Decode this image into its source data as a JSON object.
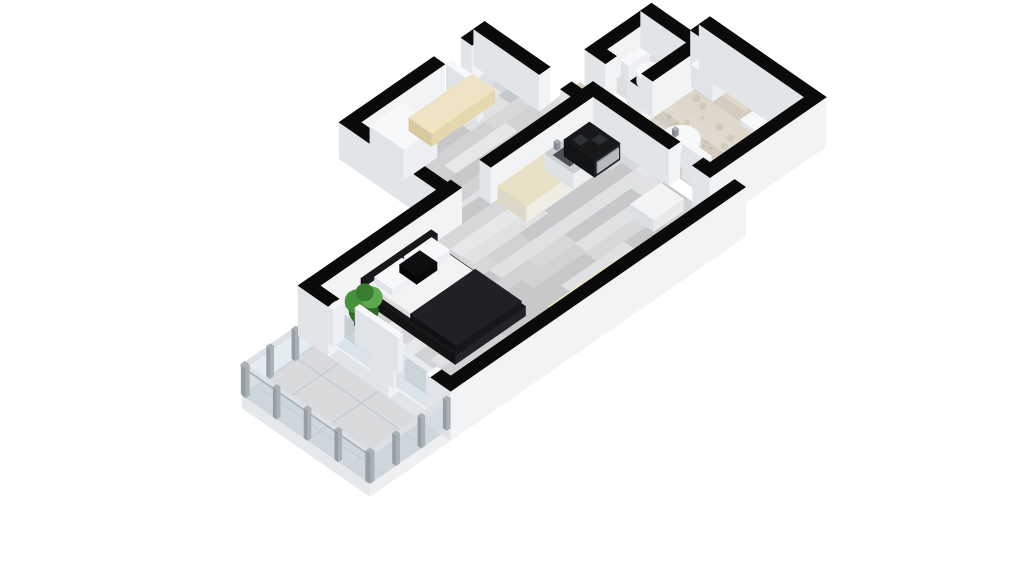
{
  "meta": {
    "kind": "3d-floorplan-render",
    "background": "#ffffff",
    "description": "Isometric 3D floor plan of a studio apartment"
  },
  "projection": {
    "ox": 320,
    "oy": 322,
    "ax": 39,
    "by": 27,
    "zs": 26,
    "wallH": 1.4
  },
  "palette": {
    "wallTop": "#0a0a0b",
    "wallS": "#f2f3f5",
    "wallW": "#e2e5e8",
    "whiteTop": "#f7f8fa",
    "whiteS": "#edeff2",
    "whiteW": "#e0e3e7",
    "creamTop": "#eee4c3",
    "creamS": "#e6d8ad",
    "creamW": "#d9c99e",
    "blackTop": "#17181a",
    "blackS": "#212326",
    "blackW": "#121315",
    "glassFill": "rgba(196,212,220,0.45)",
    "glassTop": "#e7ecef",
    "post": "#a9b0b6",
    "rail": "#dde1e5",
    "plankBase": "#d4d6d8",
    "planks": [
      "#d6d8da",
      "#cdcfd1",
      "#dfe1e3",
      "#c6c8ca",
      "#e5e7e9",
      "#d0d2d4"
    ],
    "stoneBase": "#d8d2c5",
    "stone": [
      "#d4cdbf",
      "#ded7ca",
      "#cbc4b4",
      "#e1dbcf"
    ],
    "speckle": "rgba(150,140,120,0.18)",
    "tileBase": "#d8dadc",
    "tileLine": "#c4c7ca",
    "wcFloor": "#dcdee0",
    "passFloor": "#d9dbdd",
    "potTop": "#45484a",
    "potS": "#313436",
    "potW": "#27292b",
    "leaf": [
      "#2e6b28",
      "#48913c",
      "#5ea94f",
      "#3a7d31"
    ],
    "steelTop": "#c9ced2",
    "sinkInset": "#4b5054",
    "tap": "#a8aeb3",
    "ovenBandS": "#b5bac0",
    "ovenBandTop": "#9aa0a6",
    "mattTop": "#f3f3f4",
    "mattS": "#e6e7e8",
    "mattW": "#dcdddf",
    "duvetTop": "#202124",
    "duvetS": "#17181a",
    "duvetW": "#101112"
  },
  "scene": [
    {
      "n": "balcony-slab",
      "t": "box",
      "r": [
        -2.35,
        0.35,
        -0.28,
        3.63
      ],
      "z": [
        -0.5,
        0
      ],
      "c": {
        "top": "#d8dadc",
        "s": "#eef0f2",
        "w": "#e6e9eb"
      }
    },
    {
      "n": "balcony-floor",
      "t": "floor",
      "poly": [
        [
          -2.35,
          0.35
        ],
        [
          -0.28,
          0.35
        ],
        [
          -0.28,
          3.63
        ],
        [
          -2.35,
          3.63
        ]
      ],
      "pat": "tiles",
      "seed": 5
    },
    {
      "n": "balcony-railing-north",
      "t": "railing",
      "r": [
        -2.35,
        0.32,
        -0.28,
        0.4
      ],
      "posts": 4
    },
    {
      "n": "hall-floor",
      "t": "floor",
      "poly": [
        [
          3.55,
          -2.5
        ],
        [
          6.72,
          -2.5
        ],
        [
          6.72,
          -0.28
        ],
        [
          3.55,
          -0.28
        ]
      ],
      "pat": "planks",
      "seed": 7
    },
    {
      "n": "wc-floor",
      "t": "floor",
      "poly": [
        [
          8.05,
          -0.7
        ],
        [
          9.2,
          -0.7
        ],
        [
          9.2,
          0.2
        ],
        [
          8.05,
          0.2
        ]
      ],
      "fill": "#dcdee0"
    },
    {
      "n": "doorway-floor",
      "t": "floor",
      "poly": [
        [
          6.72,
          -1.1
        ],
        [
          7.28,
          -1.1
        ],
        [
          7.28,
          -0.55
        ],
        [
          6.72,
          -0.55
        ]
      ],
      "fill": "#d9dbdd"
    },
    {
      "n": "bathroom-floor",
      "t": "floor",
      "poly": [
        [
          7.28,
          -1.1
        ],
        [
          7.77,
          -1.1
        ],
        [
          7.77,
          0.48
        ],
        [
          9.48,
          0.48
        ],
        [
          9.48,
          0.3
        ],
        [
          9.7,
          0.3
        ],
        [
          9.7,
          2.72
        ],
        [
          7.28,
          2.72
        ]
      ],
      "pat": "stone",
      "seed": 3
    },
    {
      "n": "main-room-floor",
      "t": "floor",
      "poly": [
        [
          0,
          0
        ],
        [
          3.63,
          0
        ],
        [
          3.63,
          -0.28
        ],
        [
          4.38,
          -0.28
        ],
        [
          4.38,
          0
        ],
        [
          7,
          0
        ],
        [
          7,
          3.35
        ],
        [
          0,
          3.35
        ]
      ],
      "pat": "planks",
      "seed": 11
    },
    {
      "n": "hall-north-wall-west",
      "t": "wall",
      "r": [
        3.27,
        -2.78,
        5.7,
        -2.5
      ]
    },
    {
      "n": "hall-north-wall-east",
      "t": "wall",
      "r": [
        6.4,
        -2.78,
        7.0,
        -2.5
      ]
    },
    {
      "n": "entry-door-leaf",
      "t": "box",
      "r": [
        5.72,
        -2.48,
        5.86,
        -1.68
      ],
      "z": [
        0,
        1.4
      ],
      "c": "white"
    },
    {
      "n": "hall-west-wall",
      "t": "wall",
      "r": [
        3.27,
        -2.5,
        3.55,
        -0.28
      ]
    },
    {
      "n": "hall-east-wall-north",
      "t": "wall",
      "r": [
        6.72,
        -2.78,
        7.0,
        -1.1
      ]
    },
    {
      "n": "hall-east-wall-south",
      "t": "wall",
      "r": [
        6.72,
        -0.55,
        7.0,
        -0.28
      ]
    },
    {
      "n": "hall-wardrobe",
      "t": "box",
      "r": [
        3.7,
        -2.42,
        4.55,
        -1.55
      ],
      "z": [
        0,
        1.18
      ],
      "c": "white"
    },
    {
      "n": "hall-bench",
      "t": "box",
      "r": [
        4.68,
        -2.4,
        6.3,
        -1.82
      ],
      "z": [
        0,
        0.5
      ],
      "c": "cream"
    },
    {
      "n": "wc-north-wall",
      "t": "wall",
      "r": [
        7.77,
        -0.98,
        9.48,
        -0.7
      ]
    },
    {
      "n": "wc-west-wall-upper",
      "t": "wall",
      "r": [
        7.77,
        -0.7,
        8.05,
        -0.45
      ]
    },
    {
      "n": "wc-west-wall-lower",
      "t": "wall",
      "r": [
        7.77,
        0.1,
        8.05,
        0.48
      ]
    },
    {
      "n": "toilet-tank",
      "t": "box",
      "r": [
        8.42,
        -0.7,
        8.94,
        -0.5
      ],
      "z": [
        0,
        0.6
      ],
      "c": "white"
    },
    {
      "n": "toilet-bowl",
      "t": "disk",
      "cx": 8.68,
      "cy": -0.22,
      "rad": 0.24,
      "z": [
        0,
        0.4
      ],
      "c": "white"
    },
    {
      "n": "wc-east-wall",
      "t": "wall",
      "r": [
        9.2,
        -0.98,
        9.48,
        0.48
      ]
    },
    {
      "n": "wc-south-wall",
      "t": "wall",
      "r": [
        8.05,
        0.2,
        9.2,
        0.48
      ]
    },
    {
      "n": "bathroom-ne-wall",
      "t": "wall",
      "r": [
        9.48,
        0.02,
        9.98,
        0.3
      ]
    },
    {
      "n": "washing-machine",
      "t": "box",
      "r": [
        9.12,
        0.4,
        9.64,
        0.95
      ],
      "z": [
        0,
        0.85
      ],
      "c": "white"
    },
    {
      "n": "shower-tray",
      "t": "box",
      "r": [
        9.04,
        1.74,
        9.64,
        2.62
      ],
      "z": [
        0,
        0.2
      ],
      "c": "white"
    },
    {
      "n": "round-washbasin",
      "t": "disk",
      "cx": 7.75,
      "cy": 1.5,
      "rad": 0.36,
      "z": [
        0,
        0.56
      ],
      "c": "white"
    },
    {
      "n": "basin-tap",
      "t": "box",
      "r": [
        7.71,
        1.32,
        7.79,
        1.4
      ],
      "z": [
        0.56,
        0.8
      ],
      "c": {
        "top": "#a8aeb3",
        "s": "#8f959b",
        "w": "#7f858b"
      }
    },
    {
      "n": "bathroom-door-leaf",
      "t": "box",
      "r": [
        7.3,
        1.98,
        7.44,
        2.6
      ],
      "z": [
        0,
        1.35
      ],
      "c": "white"
    },
    {
      "n": "bathroom-west-wall",
      "t": "wall",
      "r": [
        7.0,
        -0.28,
        7.28,
        1.95
      ]
    },
    {
      "n": "bathroom-west-wall-south",
      "t": "wall",
      "r": [
        7.0,
        2.55,
        7.28,
        3.63
      ],
      "z0": -0.5
    },
    {
      "n": "main-north-wall-west",
      "t": "wall",
      "r": [
        -0.28,
        -0.28,
        3.63,
        0
      ]
    },
    {
      "n": "main-north-wall-east",
      "t": "wall",
      "r": [
        4.38,
        -0.28,
        7.0,
        0
      ]
    },
    {
      "n": "kitchen-cabinets",
      "t": "box",
      "r": [
        4.5,
        0.06,
        5.7,
        0.8
      ],
      "z": [
        0,
        0.62
      ],
      "c": {
        "top": "#e9e1c6",
        "s": "#efede4",
        "w": "#ded8c6"
      }
    },
    {
      "n": "kitchen-sink-unit",
      "t": "box",
      "r": [
        5.7,
        0.06,
        6.2,
        0.8
      ],
      "z": [
        0,
        0.62
      ],
      "c": {
        "top": "#c9ced2",
        "s": "#eceeef",
        "w": "#dfe2e4"
      }
    },
    {
      "n": "kitchen-sink-inset",
      "t": "flat",
      "r": [
        5.78,
        0.2,
        6.12,
        0.62
      ],
      "zf": 0.63,
      "fill": "#4b5054"
    },
    {
      "n": "kitchen-tap",
      "t": "box",
      "r": [
        5.92,
        0.08,
        6.0,
        0.16
      ],
      "z": [
        0.62,
        0.88
      ],
      "c": {
        "top": "#a8aeb3",
        "s": "#8f959b",
        "w": "#7f858b"
      }
    },
    {
      "n": "stove-oven",
      "t": "box",
      "r": [
        6.2,
        0.06,
        6.85,
        0.84
      ],
      "z": [
        0,
        0.64
      ],
      "c": "black"
    },
    {
      "n": "oven-door-band",
      "t": "box",
      "r": [
        6.26,
        0.84,
        6.8,
        0.86
      ],
      "z": [
        0.12,
        0.52
      ],
      "c": {
        "top": "#9aa0a6",
        "s": "#b5bac0",
        "w": "#8a9096"
      }
    },
    {
      "n": "stove-burner-1",
      "t": "flat",
      "r": [
        6.3,
        0.18,
        6.5,
        0.38
      ],
      "zf": 0.65,
      "fill": "#2c2f33"
    },
    {
      "n": "stove-burner-2",
      "t": "flat",
      "r": [
        6.55,
        0.42,
        6.75,
        0.62
      ],
      "zf": 0.65,
      "fill": "#2c2f33"
    },
    {
      "n": "side-table",
      "t": "box",
      "r": [
        5.95,
        2.02,
        6.72,
        2.6
      ],
      "z": [
        0,
        0.46
      ],
      "c": {
        "top": "#f3f4f6",
        "s": "#e7e9eb",
        "w": "#dcdfe2"
      }
    },
    {
      "n": "bed-frame",
      "t": "box",
      "r": [
        0.95,
        0.1,
        2.75,
        2.52
      ],
      "z": [
        0,
        0.36
      ],
      "c": "black2"
    },
    {
      "n": "bed-headboard",
      "t": "box",
      "r": [
        0.95,
        0.1,
        2.75,
        0.26
      ],
      "z": [
        0,
        0.8
      ],
      "c": "black2"
    },
    {
      "n": "bed-mattress",
      "t": "box",
      "r": [
        1.06,
        0.2,
        2.64,
        1.52
      ],
      "z": [
        0.36,
        0.56
      ],
      "c": {
        "top": "#f3f3f4",
        "s": "#e6e7e8",
        "w": "#dcdddf"
      }
    },
    {
      "n": "bed-duvet",
      "t": "box",
      "r": [
        1.02,
        1.3,
        2.68,
        2.48
      ],
      "z": [
        0.36,
        0.6
      ],
      "c": {
        "top": "#202124",
        "s": "#17181a",
        "w": "#101112"
      }
    },
    {
      "n": "pillow-left",
      "t": "box",
      "r": [
        1.14,
        0.26,
        1.84,
        0.72
      ],
      "z": [
        0.56,
        0.82
      ],
      "c": "white"
    },
    {
      "n": "pillow-right",
      "t": "box",
      "r": [
        1.9,
        0.26,
        2.6,
        0.72
      ],
      "z": [
        0.56,
        0.82
      ],
      "c": "white"
    },
    {
      "n": "pillow-accent-black",
      "t": "box",
      "r": [
        1.64,
        0.4,
        2.16,
        0.84
      ],
      "z": [
        0.62,
        0.92
      ],
      "c": {
        "top": "#0e0e10",
        "s": "#09090a",
        "w": "#060607"
      }
    },
    {
      "n": "bench-main-room",
      "t": "box",
      "r": [
        3.0,
        2.86,
        4.72,
        3.33
      ],
      "z": [
        0,
        0.46
      ],
      "c": "cream"
    },
    {
      "n": "tv-bench",
      "t": "box",
      "r": [
        4.95,
        3.06,
        6.6,
        3.34
      ],
      "z": [
        0,
        0.3
      ],
      "c": "black2"
    },
    {
      "n": "bathroom-east-wall",
      "t": "wall",
      "r": [
        9.7,
        0.02,
        9.98,
        3.0
      ],
      "z0": -0.5
    },
    {
      "n": "bathroom-south-wall",
      "t": "wall",
      "r": [
        7.0,
        2.72,
        9.98,
        3.0
      ],
      "z0": -0.5
    },
    {
      "n": "main-south-wall",
      "t": "wall",
      "r": [
        -0.28,
        3.35,
        7.28,
        3.63
      ],
      "z0": -0.5
    },
    {
      "n": "west-plinth",
      "t": "box",
      "r": [
        -0.28,
        0.4,
        0,
        3.2
      ],
      "z": [
        -0.5,
        0.03
      ],
      "c": {
        "top": "#eef0f2",
        "s": "#f2f3f5",
        "w": "#e2e5e8"
      }
    },
    {
      "n": "west-wall-north",
      "t": "wall",
      "r": [
        -0.28,
        -0.28,
        0,
        0.5
      ],
      "z0": -0.5
    },
    {
      "n": "balcony-door-glass",
      "t": "glass",
      "r": [
        -0.22,
        0.5,
        -0.1,
        1.7
      ],
      "z": [
        0,
        1.42
      ]
    },
    {
      "n": "door-frame-post-1",
      "t": "box",
      "r": [
        -0.28,
        0.5,
        0,
        0.62
      ],
      "z": [
        0,
        1.4
      ],
      "c": "white"
    },
    {
      "n": "door-frame-post-2",
      "t": "box",
      "r": [
        -0.28,
        1.58,
        0,
        1.7
      ],
      "z": [
        0,
        1.4
      ],
      "c": "white"
    },
    {
      "n": "west-wall-mid",
      "t": "wall",
      "r": [
        -0.28,
        1.7,
        0,
        2.05
      ],
      "z0": -0.5
    },
    {
      "n": "window-frame-post-1",
      "t": "box",
      "r": [
        -0.28,
        2.05,
        0,
        2.17
      ],
      "z": [
        0,
        1.4
      ],
      "c": "white"
    },
    {
      "n": "window-glass",
      "t": "glass",
      "r": [
        -0.22,
        2.17,
        -0.1,
        3.0
      ],
      "z": [
        0,
        1.42
      ]
    },
    {
      "n": "window-frame-post-2",
      "t": "box",
      "r": [
        -0.28,
        3.0,
        0,
        3.12
      ],
      "z": [
        0,
        1.4
      ],
      "c": "white"
    },
    {
      "n": "west-wall-south",
      "t": "wall",
      "r": [
        -0.28,
        3.12,
        0,
        3.63
      ],
      "z0": -0.5
    },
    {
      "n": "plant-pot",
      "t": "box",
      "r": [
        0.38,
        0.5,
        0.62,
        0.74
      ],
      "z": [
        0,
        0.34
      ],
      "c": {
        "top": "#45484a",
        "s": "#313436",
        "w": "#27292b"
      }
    },
    {
      "n": "plant-foliage",
      "t": "plant",
      "cx": 0.5,
      "cy": 0.62,
      "zf": 0.8
    },
    {
      "n": "sliding-door-leaf",
      "t": "box",
      "r": [
        0.05,
        0.85,
        0.17,
        1.95
      ],
      "z": [
        0,
        1.38
      ],
      "c": "white"
    },
    {
      "n": "balcony-railing-west",
      "t": "railing",
      "r": [
        -2.35,
        0.35,
        -2.27,
        3.63
      ],
      "posts": 5
    },
    {
      "n": "balcony-railing-south",
      "t": "railing",
      "r": [
        -2.35,
        3.55,
        -0.28,
        3.63
      ],
      "posts": 4
    }
  ]
}
